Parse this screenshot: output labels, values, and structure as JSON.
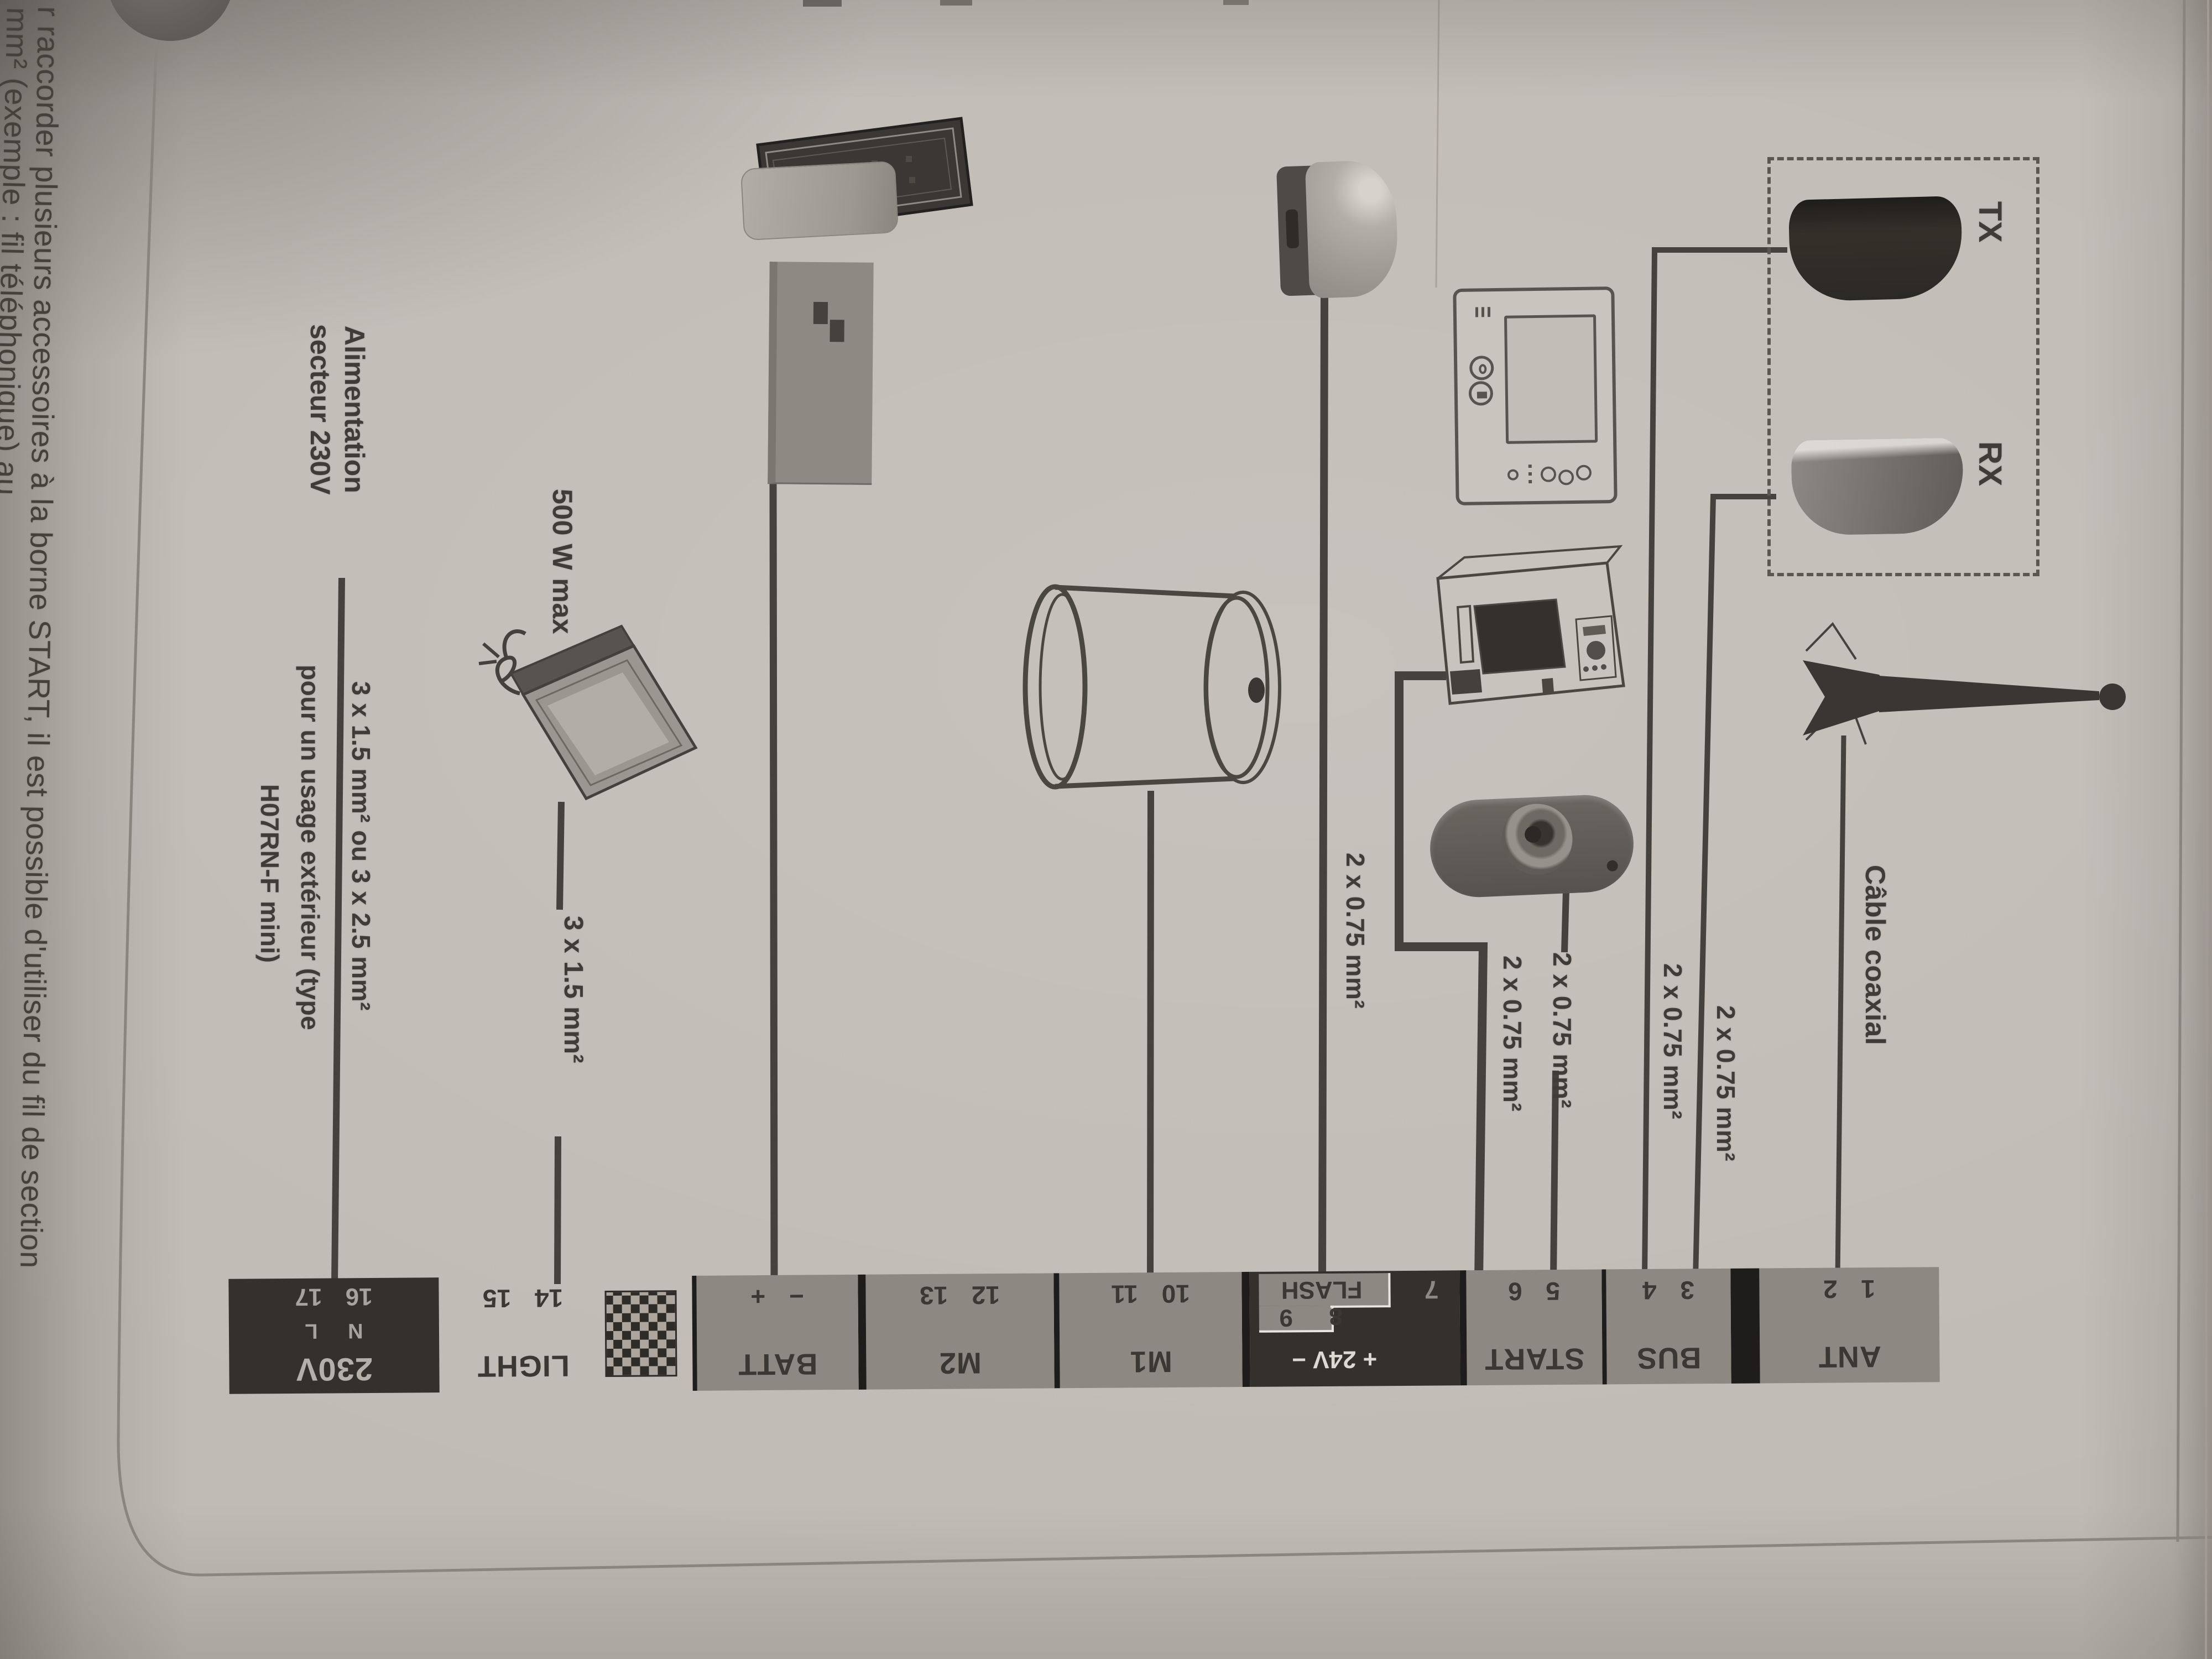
{
  "page": {
    "kind": "wiring-diagram photo (rotated 90°)",
    "colors": {
      "paper": "#c1bbb5",
      "ink": "#3f3b37",
      "terminal_grey": "#8d8882",
      "terminal_black": "#34312d",
      "terminal_light_text": "#b5afa9",
      "white_wire_text": "#ddd8d2"
    }
  },
  "paragraph": {
    "line1": "r raccorder plusieurs accessoires à la borne START, il est possible d'utiliser du fil de section",
    "line2": "mm² (exemple : fil téléphonique) au…"
  },
  "dashed_group": {
    "tx": "TX",
    "rx": "RX"
  },
  "wire_labels": {
    "coax": "Câble coaxial",
    "w075": "2 x 0.75 mm²",
    "w15": "3 x 1.5 mm²",
    "lamp_max": "500 W max",
    "mains_1": "Alimentation",
    "mains_2": "secteur 230V",
    "mains_gauge_1": "3 x 1.5 mm² ou 3 x 2.5 mm²",
    "mains_gauge_2": "pour un usage extérieur (type",
    "mains_gauge_3": "H07RN-F mini)"
  },
  "strip": {
    "ant": {
      "label": "ANT",
      "numbers": "1 2"
    },
    "bus": {
      "label": "BUS",
      "numbers": "3 4"
    },
    "start": {
      "label": "START",
      "numbers": "5 6"
    },
    "flash": {
      "label": "FLASH",
      "aux": "+ 24V −",
      "t7": "7",
      "t8": "8",
      "t9": "9"
    },
    "m1": {
      "label": "M1",
      "numbers": "10 11"
    },
    "m2": {
      "label": "M2",
      "numbers": "12 13"
    },
    "batt": {
      "label": "BATT",
      "numbers": "− +"
    },
    "light": {
      "label": "LIGHT",
      "numbers": "14 15"
    },
    "mains": {
      "label": "230V",
      "sub": "N L",
      "numbers": "16 17"
    }
  }
}
